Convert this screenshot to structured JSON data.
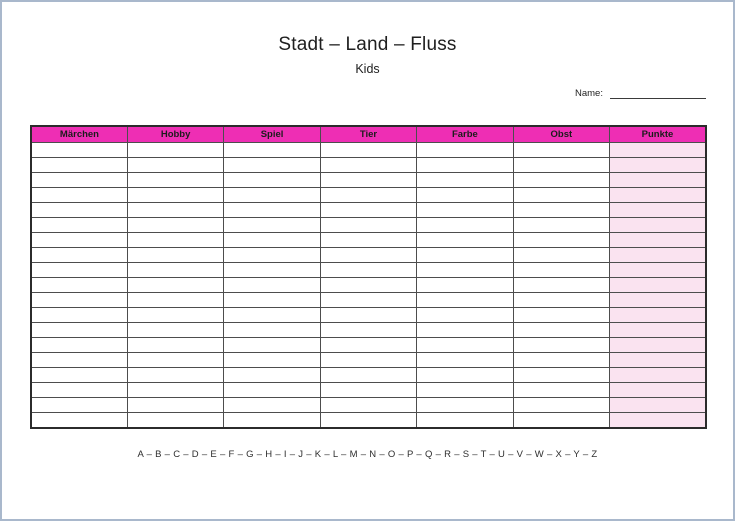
{
  "page": {
    "title": "Stadt – Land – Fluss",
    "subtitle": "Kids",
    "name_label": "Name:",
    "alphabet": "A – B – C – D – E – F – G – H – I – J – K – L – M – N – O – P – Q – R – S – T – U – V – W – X – Y – Z"
  },
  "table": {
    "columns": [
      "Märchen",
      "Hobby",
      "Spiel",
      "Tier",
      "Farbe",
      "Obst",
      "Punkte"
    ],
    "row_count": 19,
    "highlight_column": "Punkte"
  },
  "colors": {
    "header_bg": "#ee2eb4",
    "highlight_cell_bg": "#fae3f0",
    "grid_line": "#4d4d4d",
    "table_outline": "#2b2b2b",
    "page_border": "#a9b8cc",
    "text": "#1f1f1f"
  }
}
